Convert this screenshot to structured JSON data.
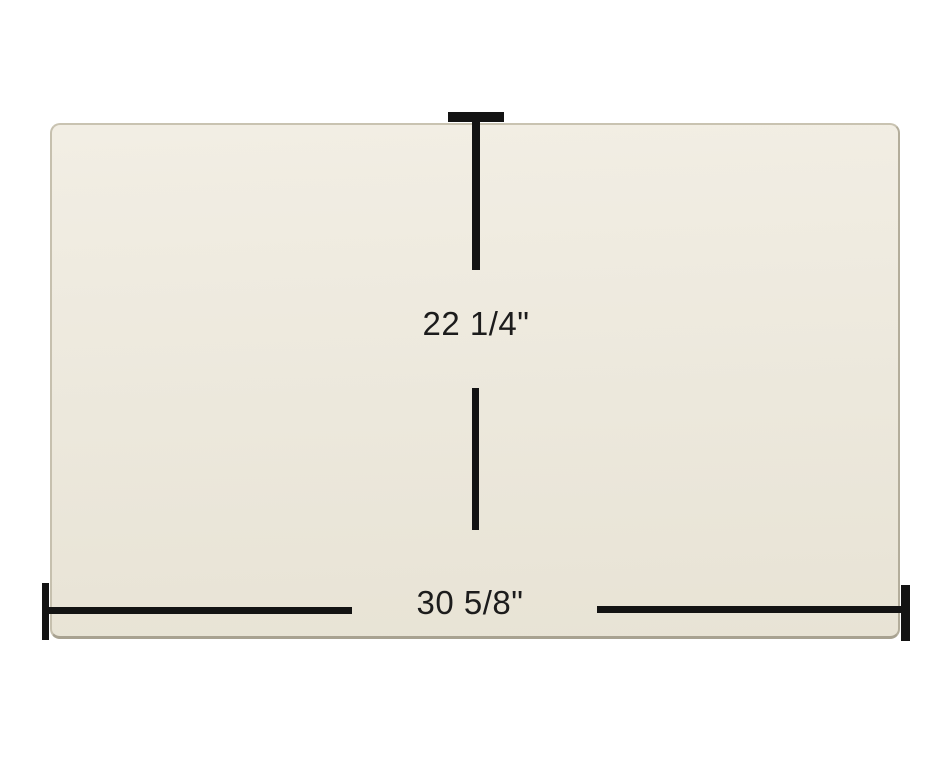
{
  "diagram": {
    "kind": "product-dimension-diagram",
    "panel": {
      "description": "cream rectangular glass panel",
      "fill_color": "#EDE9DE",
      "edge_color": "#A8A291"
    },
    "line_color": "#131313",
    "text_color": "#1C1C1C",
    "background_color": "#FFFFFF",
    "dimensions": {
      "height_label": "22 1/4\"",
      "width_label": "30 5/8\""
    }
  }
}
